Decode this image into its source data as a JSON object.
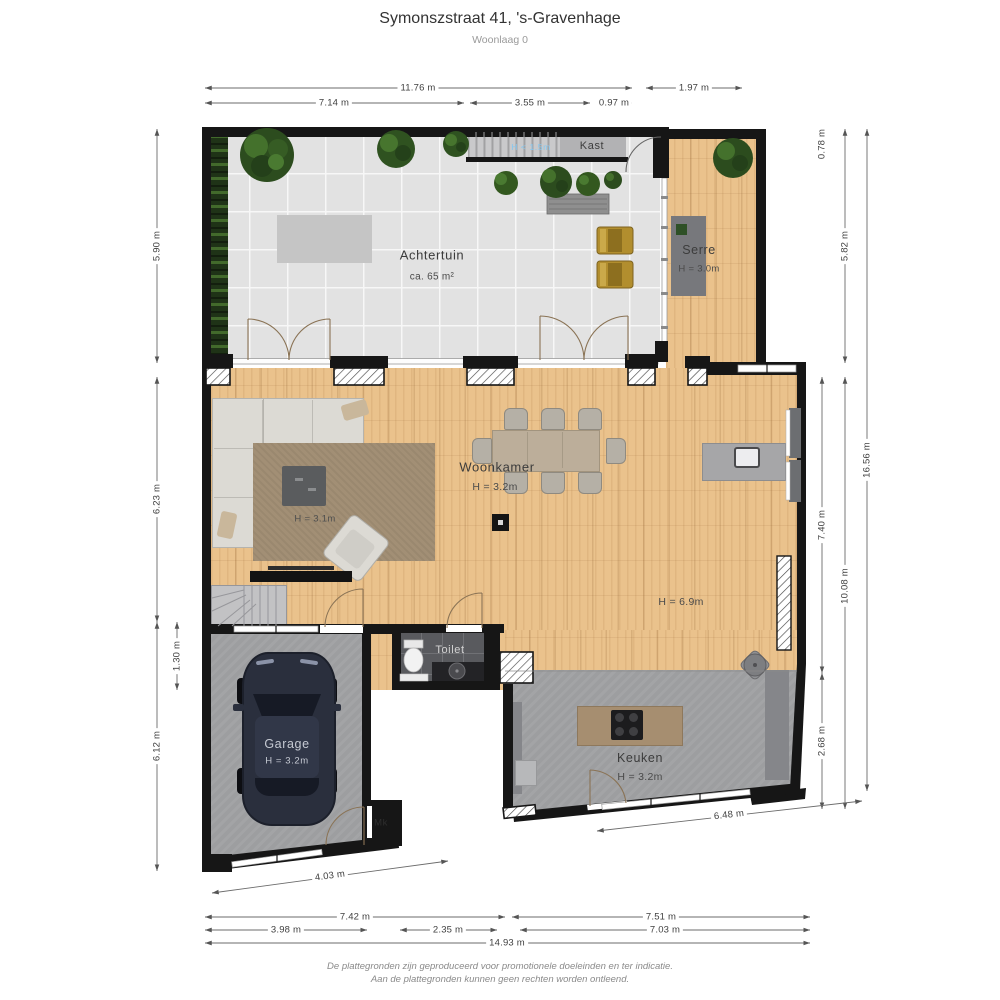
{
  "header": {
    "title": "Symonszstraat 41, 's-Gravenhage",
    "subtitle": "Woonlaag 0"
  },
  "rooms": {
    "achtertuin": {
      "label": "Achtertuin",
      "area": "ca. 65 m²"
    },
    "serre": {
      "label": "Serre",
      "height": "H = 3.0m"
    },
    "kast": {
      "label": "Kast",
      "clearance": "H < 1.5m"
    },
    "woonkamer": {
      "label": "Woonkamer",
      "height": "H = 3.2m",
      "sofa_height": "H = 3.1m",
      "void_height": "H = 6.9m"
    },
    "toilet": {
      "label": "Toilet"
    },
    "garage": {
      "label": "Garage",
      "height": "H = 3.2m"
    },
    "keuken": {
      "label": "Keuken",
      "height": "H = 3.2m"
    },
    "meterkast": {
      "label": "Mk"
    }
  },
  "dims": {
    "w_total_top": "11.76 m",
    "w_serre_top": "1.97 m",
    "w_top_a": "7.14 m",
    "w_top_b": "3.55 m",
    "w_top_c": "0.97 m",
    "h_garden": "5.90 m",
    "h_living_left": "6.23 m",
    "h_step": "1.30 m",
    "h_garage_left": "6.12 m",
    "h_offset_right": "0.78 m",
    "h_serre_right": "5.82 m",
    "h_total_right": "16.56 m",
    "h_living_right": "7.40 m",
    "h_lower_right": "10.08 m",
    "h_kitchen_right": "2.68 m",
    "w_garage_front": "4.03 m",
    "w_kitchen_front": "6.48 m",
    "w_bottom_left": "7.42 m",
    "w_bottom_right": "7.51 m",
    "w_bottom_a": "3.98 m",
    "w_bottom_b": "2.35 m",
    "w_bottom_c": "7.03 m",
    "w_total_bottom": "14.93 m"
  },
  "footer": {
    "line1": "De plattegronden zijn geproduceerd voor promotionele doeleinden en ter indicatie.",
    "line2": "Aan de plattegronden kunnen geen rechten worden ontleend."
  }
}
